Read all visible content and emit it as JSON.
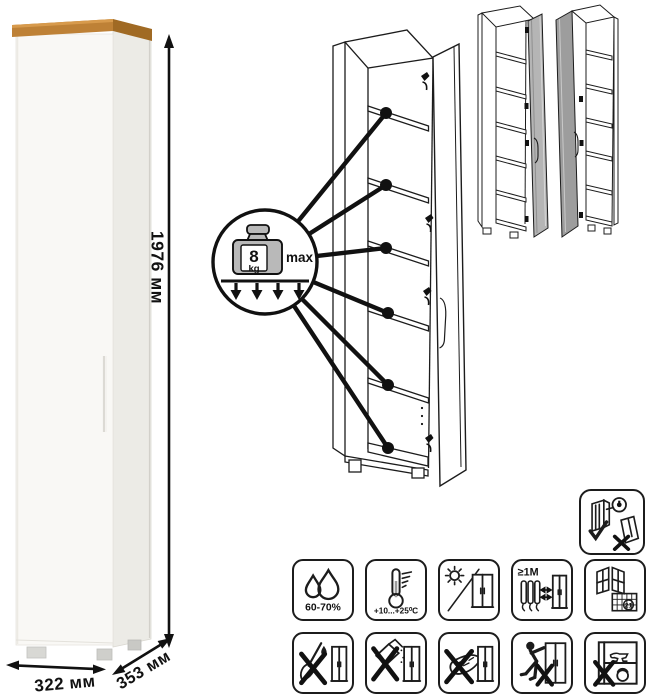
{
  "dimensions": {
    "height": "1976 мм",
    "width": "322 мм",
    "depth": "353 мм"
  },
  "shelf_load": {
    "value": "8",
    "unit": "kg",
    "qualifier": "max"
  },
  "care_guidelines": {
    "humidity_range": "60-70%",
    "temperature_range": "+10...+25⁰C",
    "heat_distance": "≥1М",
    "airing_day": "21"
  },
  "colors": {
    "wood_top": "#BE8136",
    "wood_top_shade": "#A06A24",
    "cabinet_front": "#F9F8F5",
    "cabinet_side": "#ECEBE6",
    "line_art": "#1c1c1c",
    "door_variant_light": "#B5B5B5",
    "door_variant_dark": "#9D9D9D",
    "weight_metal": "#B9B9B9"
  }
}
